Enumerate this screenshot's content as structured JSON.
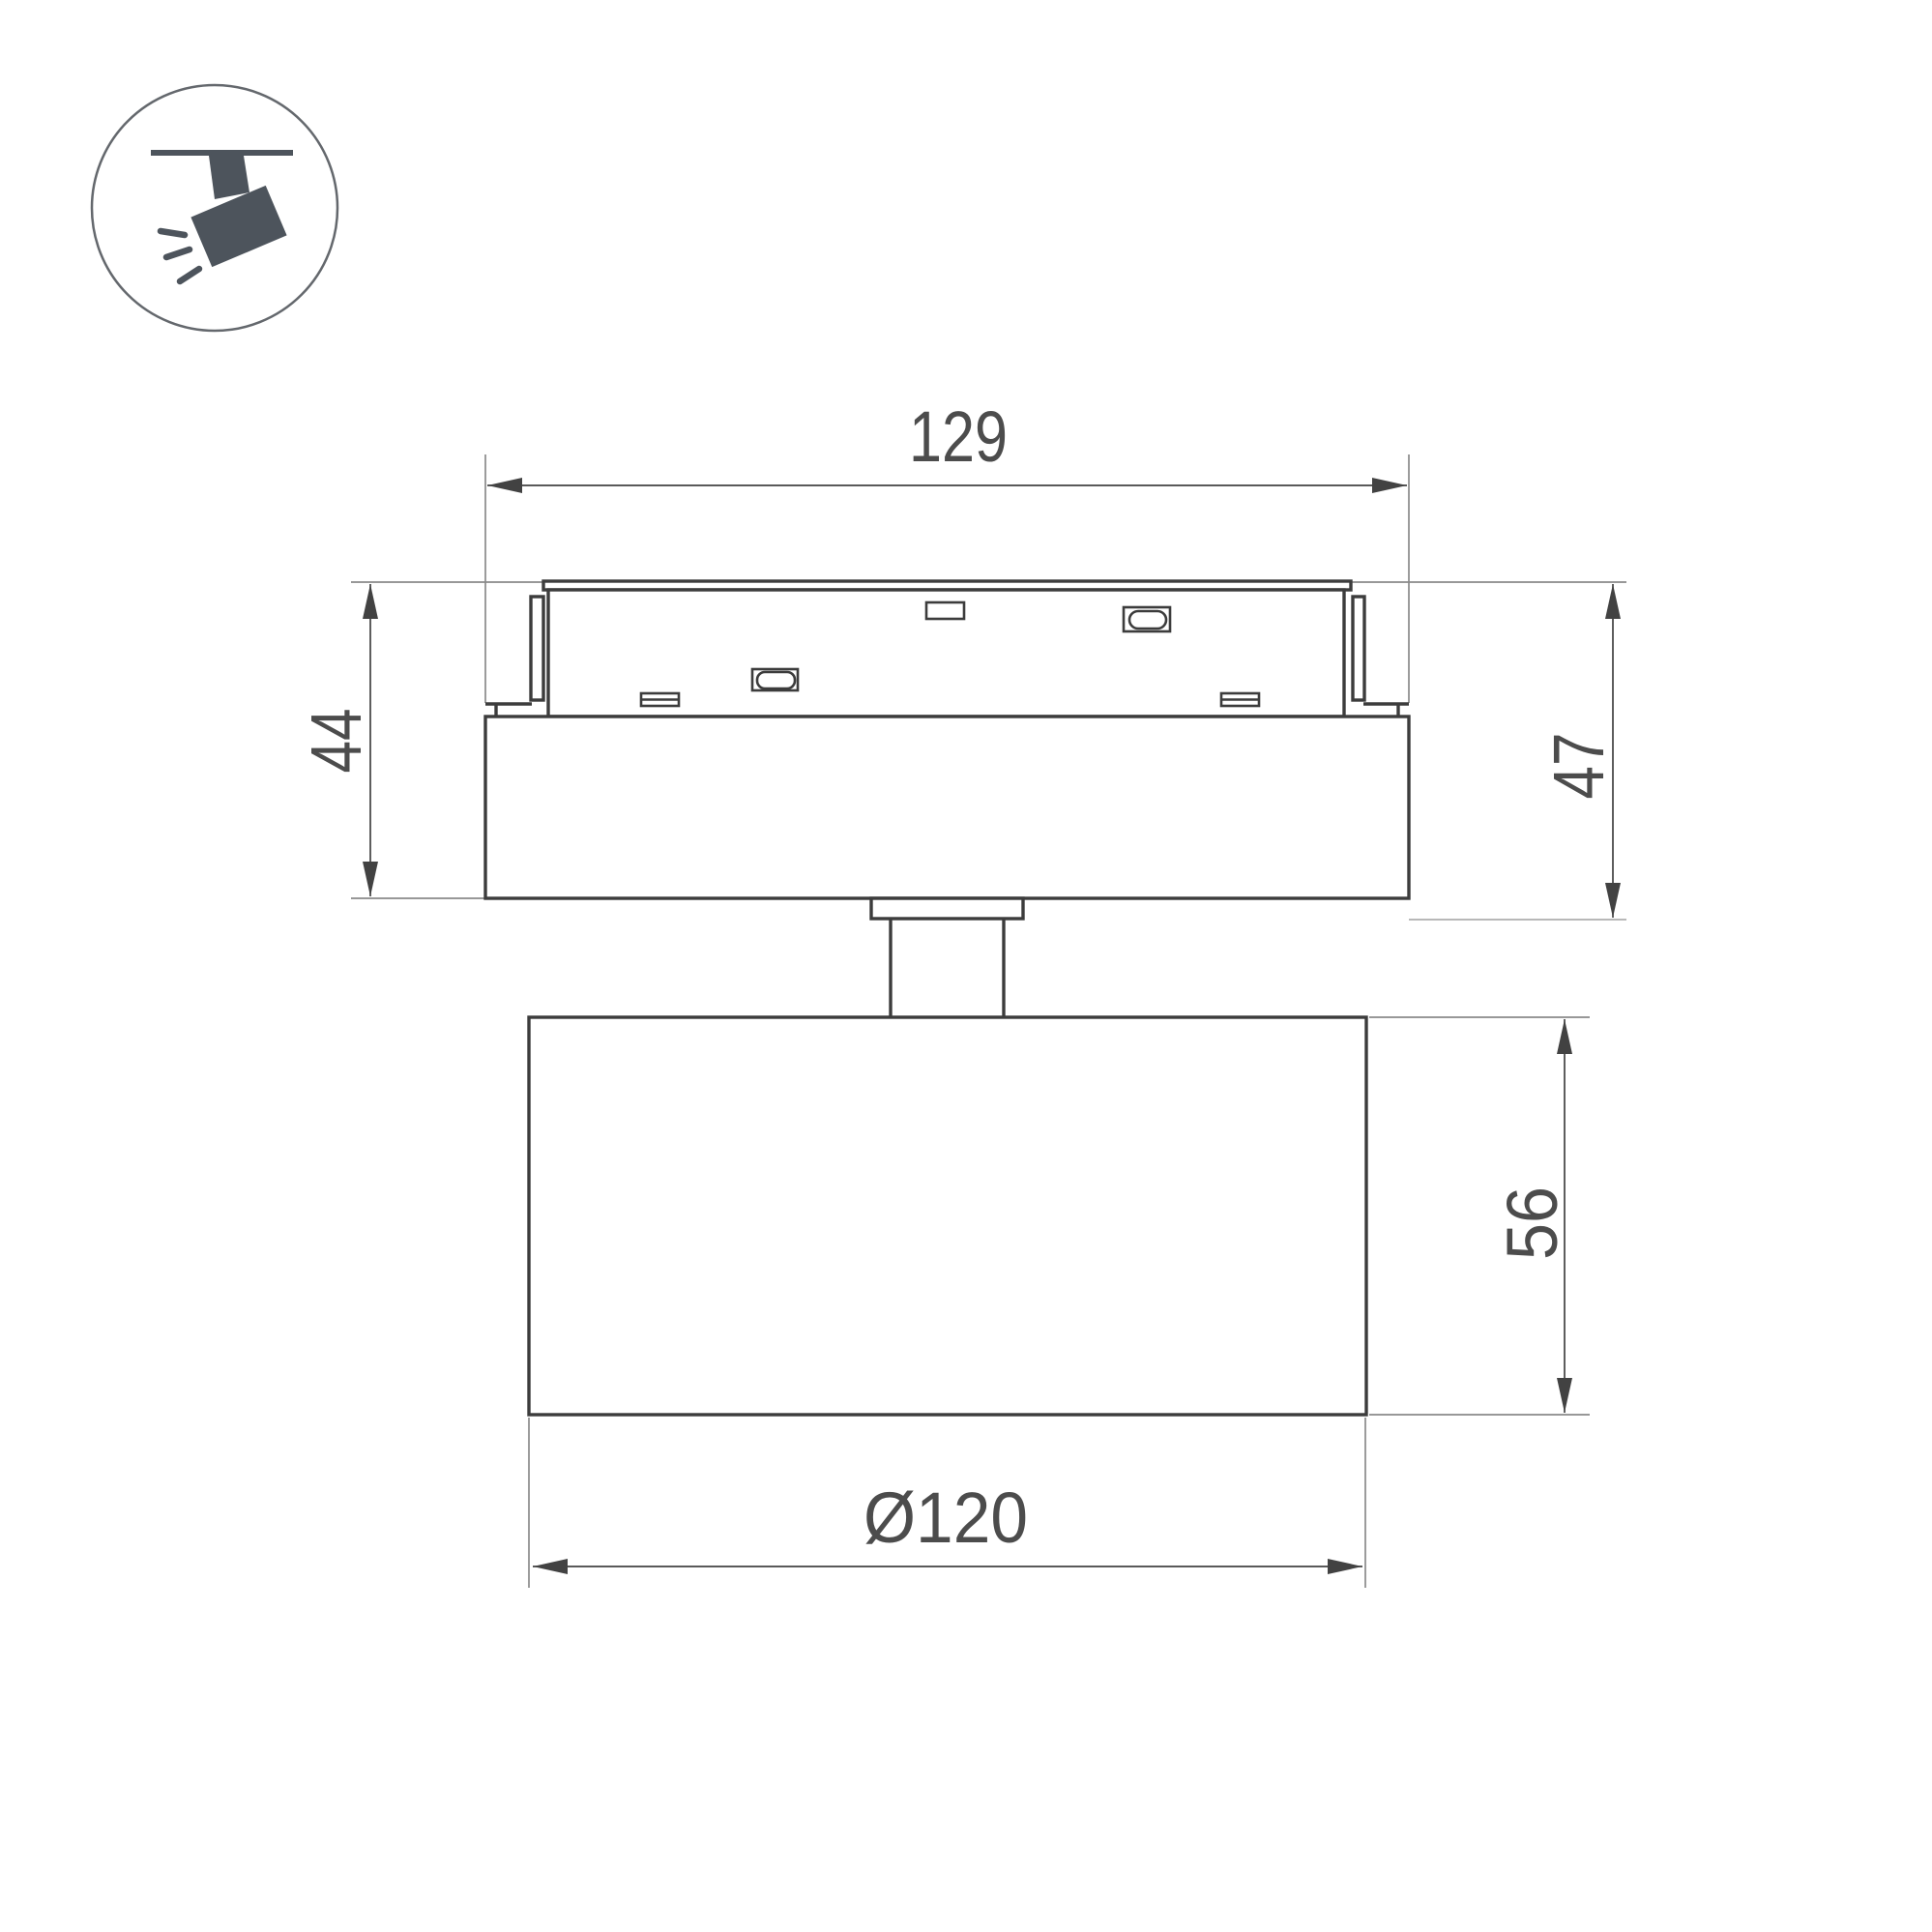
{
  "window": {
    "background": "#ffffff"
  },
  "icon": {
    "name": "track-spotlight",
    "glyph_color": "#4d545c",
    "circle_color": "#64686d"
  },
  "drawing": {
    "type": "product-dimension-drawing",
    "subject": "magnetic track spotlight, side view",
    "dimensions": {
      "track_mount_width": "129",
      "mount_height": "44",
      "overall_mount_height": "47",
      "lamp_body_height": "56",
      "lamp_body_diameter": "Ø120"
    },
    "colors": {
      "outline": "#3c3c3c",
      "dimension_line": "#424242",
      "extension_line": "#8a8a8a",
      "extension_line_light": "#aeaeae",
      "label_text": "#4c4c4c"
    }
  }
}
